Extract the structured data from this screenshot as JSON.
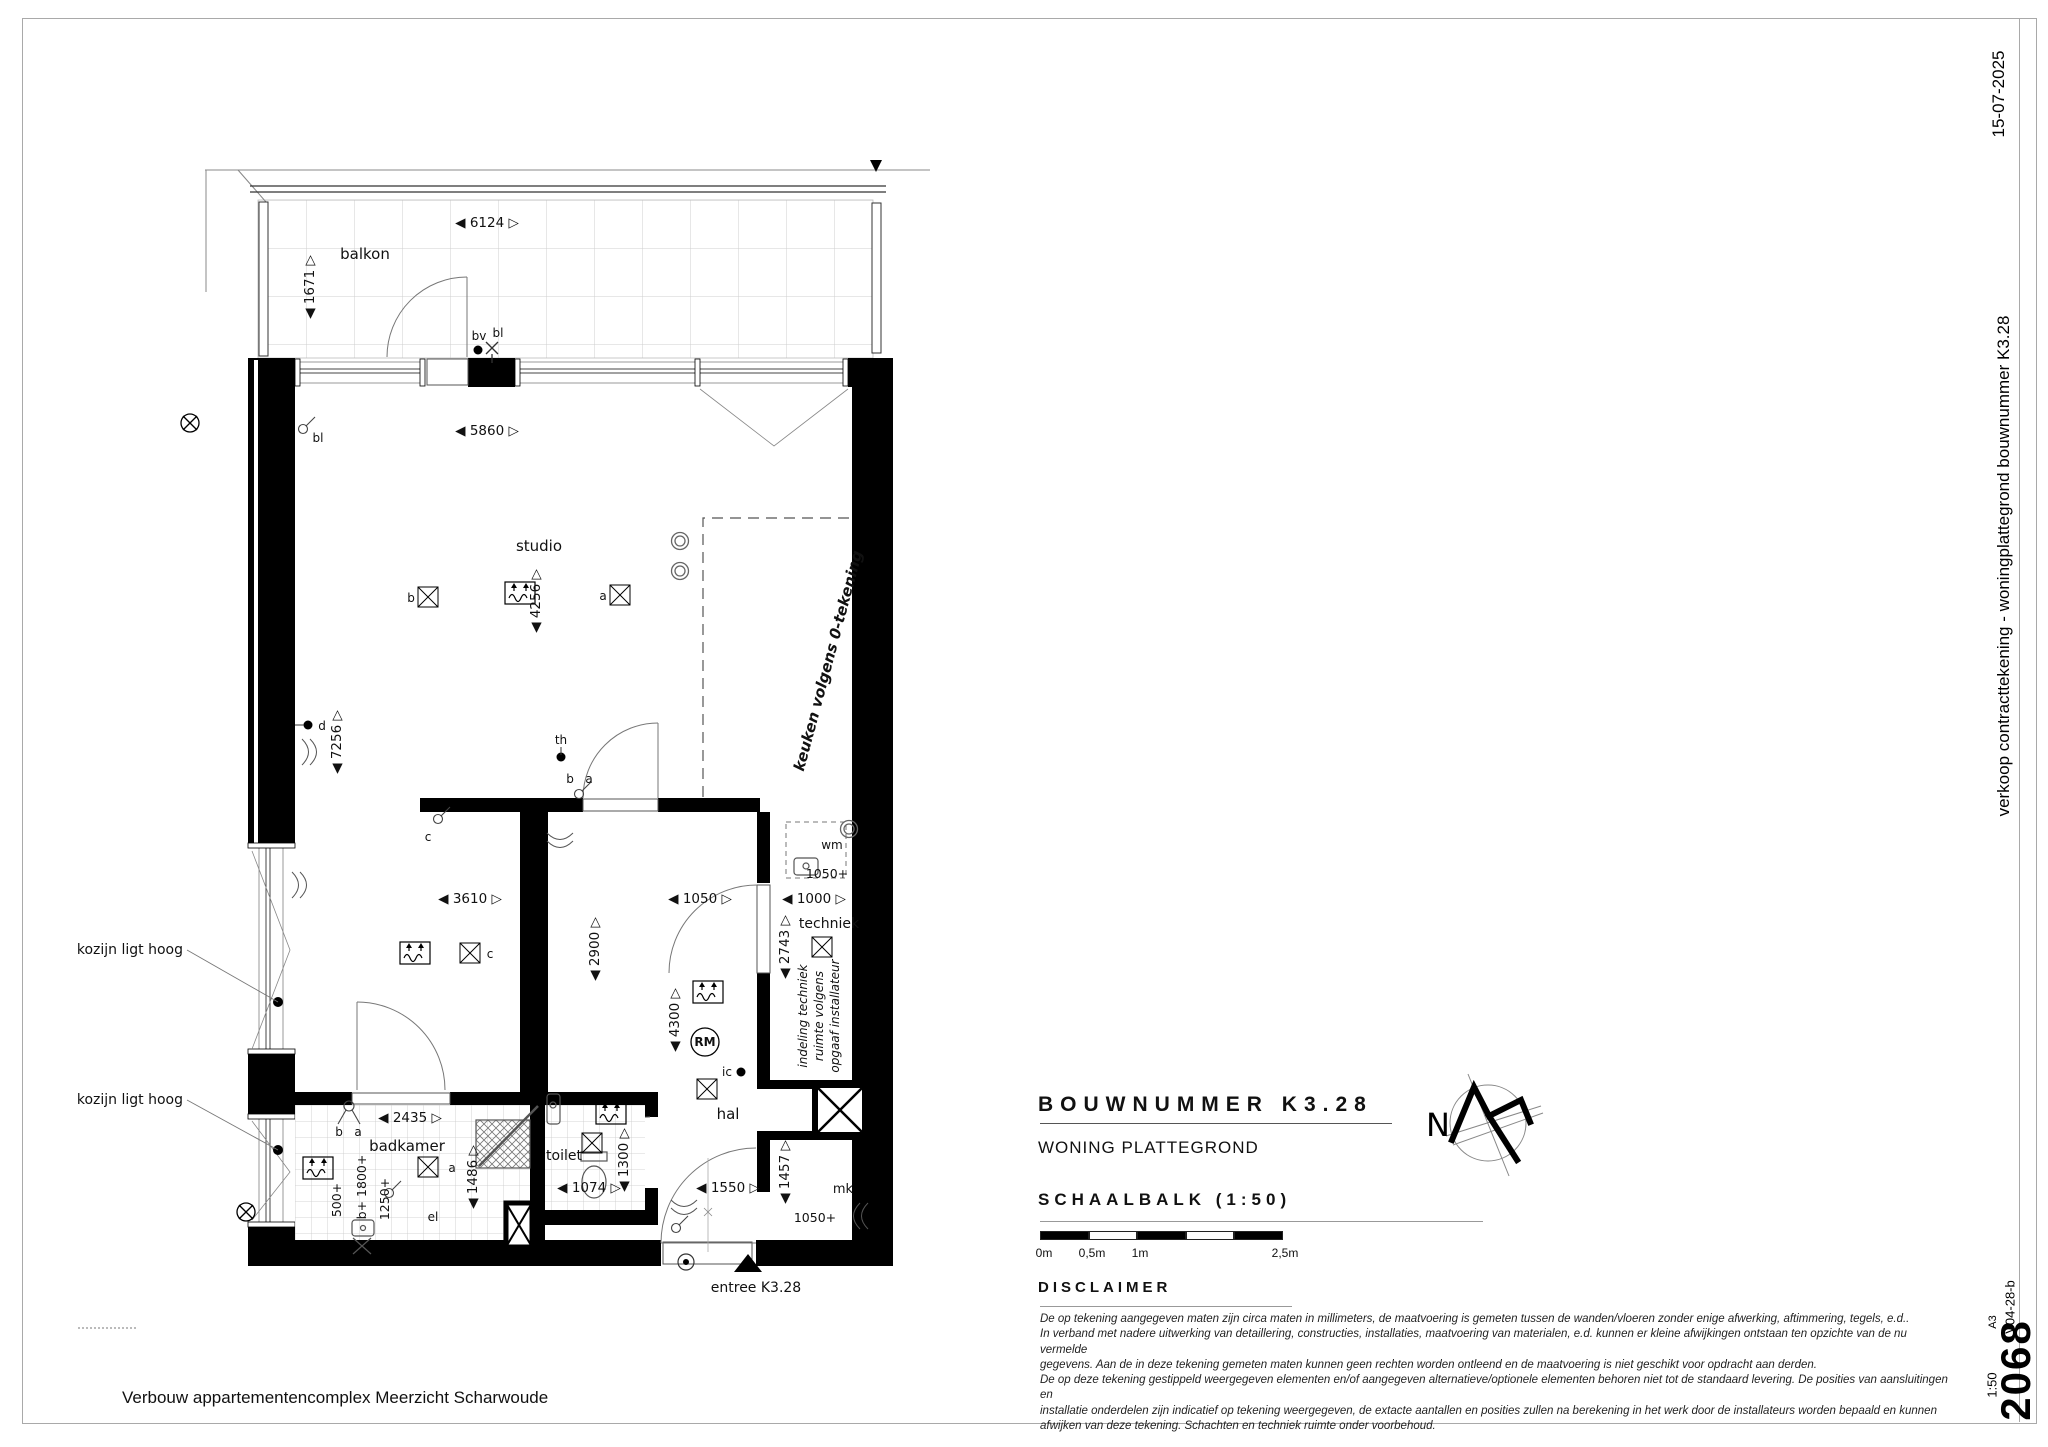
{
  "sheet": {
    "date": "15-07-2025",
    "side_title": "verkoop contracttekening - woningplattegrond bouwnummer K3.28",
    "doc_number": "2068",
    "version": "V04-28-b",
    "paper_size": "A3",
    "scale": "1:50",
    "footer_title": "Verbouw appartementencomplex Meerzicht Scharwoude"
  },
  "titleblock": {
    "bouwnummer_label": "BOUWNUMMER K3.28",
    "subtitle": "WONING PLATTEGROND",
    "schaalbalk_label": "SCHAALBALK (1:50)",
    "scale_ticks": [
      "0m",
      "0,5m",
      "1m",
      "2,5m"
    ],
    "disclaimer_label": "DISCLAIMER",
    "disclaimer_lines": [
      "De op tekening aangegeven maten zijn circa maten in millimeters, de maatvoering is gemeten tussen de wanden/vloeren zonder enige afwerking, aftimmering, tegels, e.d..",
      "In verband met nadere uitwerking van detaillering, constructies, installaties, maatvoering van materialen, e.d. kunnen er kleine afwijkingen ontstaan ten opzichte van de nu vermelde",
      "gegevens. Aan de in deze tekening gemeten maten kunnen geen rechten worden ontleend en de maatvoering is niet geschikt voor opdracht aan derden.",
      "De op deze tekening gestippeld weergegeven elementen en/of aangegeven alternatieve/optionele elementen behoren niet tot de standaard levering. De posities van aansluitingen en",
      "installatie onderdelen zijn indicatief op tekening weergegeven, de extacte aantallen en posities zullen na berekening in het werk door de installateurs worden bepaald en kunnen",
      "afwijken van deze tekening. Schachten en techniek ruimte onder voorbehoud."
    ],
    "north_label": "N"
  },
  "plan": {
    "room_labels": [
      {
        "t": "balkon",
        "x": 365,
        "y": 259,
        "s": 15
      },
      {
        "t": "studio",
        "x": 539,
        "y": 551,
        "s": 15
      },
      {
        "t": "badkamer",
        "x": 407,
        "y": 1151,
        "s": 15
      },
      {
        "t": "toilet",
        "x": 564,
        "y": 1160,
        "s": 14
      },
      {
        "t": "hal",
        "x": 728,
        "y": 1119,
        "s": 15
      },
      {
        "t": "techniek",
        "x": 829,
        "y": 928,
        "s": 14
      },
      {
        "t": "mk",
        "x": 843,
        "y": 1193,
        "s": 13
      },
      {
        "t": "wm",
        "x": 832,
        "y": 849,
        "s": 12
      }
    ],
    "small_labels": [
      {
        "t": "b",
        "x": 411,
        "y": 602,
        "s": 12
      },
      {
        "t": "a",
        "x": 603,
        "y": 600,
        "s": 12
      },
      {
        "t": "c",
        "x": 490,
        "y": 958,
        "s": 12
      },
      {
        "t": "c",
        "x": 428,
        "y": 841,
        "s": 12
      },
      {
        "t": "d",
        "x": 322,
        "y": 730,
        "s": 12
      },
      {
        "t": "b",
        "x": 339,
        "y": 1136,
        "s": 12
      },
      {
        "t": "a",
        "x": 358,
        "y": 1136,
        "s": 12
      },
      {
        "t": "a",
        "x": 452,
        "y": 1172,
        "s": 12
      },
      {
        "t": "b",
        "x": 570,
        "y": 783,
        "s": 12
      },
      {
        "t": "a",
        "x": 589,
        "y": 783,
        "s": 12
      },
      {
        "t": "bl",
        "x": 318,
        "y": 442,
        "s": 12
      },
      {
        "t": "bl",
        "x": 498,
        "y": 337,
        "s": 12
      },
      {
        "t": "bv",
        "x": 479,
        "y": 340,
        "s": 12
      },
      {
        "t": "th",
        "x": 561,
        "y": 744,
        "s": 12
      },
      {
        "t": "ic",
        "x": 727,
        "y": 1076,
        "s": 12
      },
      {
        "t": "el",
        "x": 433,
        "y": 1221,
        "s": 12
      },
      {
        "t": "RM",
        "x": 705,
        "y": 1046,
        "s": 12,
        "bold": true
      }
    ],
    "dims": [
      {
        "v": "6124",
        "x": 487,
        "y": 227,
        "o": "h"
      },
      {
        "v": "5860",
        "x": 487,
        "y": 435,
        "o": "h"
      },
      {
        "v": "1671",
        "x": 314,
        "y": 287,
        "o": "v"
      },
      {
        "v": "4256",
        "x": 540,
        "y": 601,
        "o": "v"
      },
      {
        "v": "7256",
        "x": 341,
        "y": 742,
        "o": "v"
      },
      {
        "v": "3610",
        "x": 470,
        "y": 903,
        "o": "h"
      },
      {
        "v": "2900",
        "x": 599,
        "y": 949,
        "o": "v"
      },
      {
        "v": "1050",
        "x": 700,
        "y": 903,
        "o": "h"
      },
      {
        "v": "1000",
        "x": 814,
        "y": 903,
        "o": "h"
      },
      {
        "v": "2743",
        "x": 789,
        "y": 947,
        "o": "v"
      },
      {
        "v": "4300",
        "x": 679,
        "y": 1020,
        "o": "v"
      },
      {
        "v": "1457",
        "x": 789,
        "y": 1172,
        "o": "v"
      },
      {
        "v": "1550",
        "x": 728,
        "y": 1192,
        "o": "h"
      },
      {
        "v": "1074",
        "x": 589,
        "y": 1192,
        "o": "h"
      },
      {
        "v": "1300",
        "x": 628,
        "y": 1160,
        "o": "v"
      },
      {
        "v": "2435",
        "x": 410,
        "y": 1122,
        "o": "h"
      },
      {
        "v": "1486",
        "x": 477,
        "y": 1177,
        "o": "v"
      }
    ],
    "plus_texts": [
      {
        "v": "1050+",
        "x": 827,
        "y": 878
      },
      {
        "v": "1050+",
        "x": 815,
        "y": 1222
      },
      {
        "v": "500+",
        "x": 341,
        "y": 1200,
        "r": -90
      },
      {
        "v": "b+ 1800+",
        "x": 366,
        "y": 1187,
        "r": -90
      },
      {
        "v": "1250+",
        "x": 389,
        "y": 1199,
        "r": -90
      }
    ],
    "notes": [
      {
        "t": "keuken volgens 0-tekening",
        "x": 833,
        "y": 662,
        "r": -75,
        "s": 15,
        "bold": true,
        "italic": true
      },
      {
        "t": "indeling techniek",
        "x": 807,
        "y": 1016,
        "r": -90,
        "s": 12,
        "italic": true
      },
      {
        "t": "ruimte volgens",
        "x": 823,
        "y": 1016,
        "r": -90,
        "s": 12,
        "italic": true
      },
      {
        "t": "opgaaf installateur",
        "x": 839,
        "y": 1016,
        "r": -90,
        "s": 12,
        "italic": true
      },
      {
        "t": "kozijn ligt hoog",
        "x": 183,
        "y": 954,
        "a": "end",
        "s": 14
      },
      {
        "t": "kozijn ligt hoog",
        "x": 183,
        "y": 1104,
        "a": "end",
        "s": 14
      },
      {
        "t": "entree K3.28",
        "x": 756,
        "y": 1292,
        "s": 14
      }
    ]
  }
}
